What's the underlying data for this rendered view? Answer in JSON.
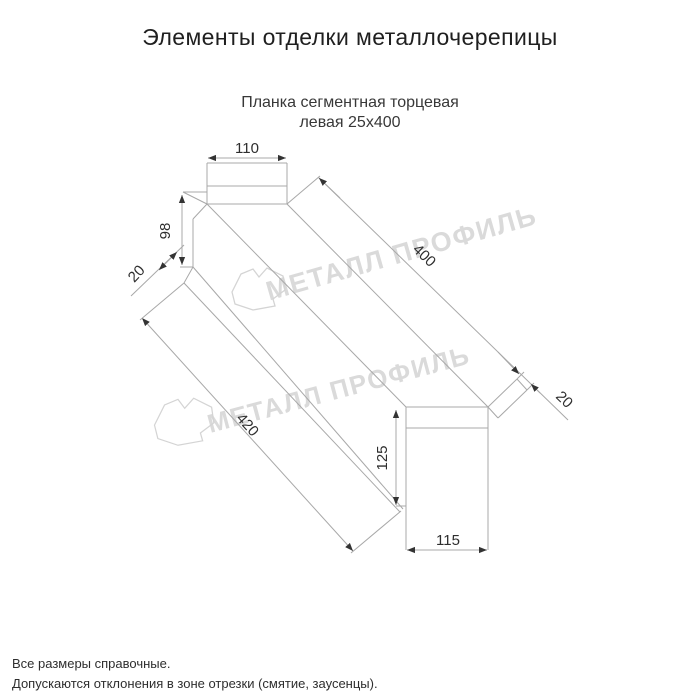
{
  "page": {
    "title": "Элементы отделки металлочерепицы"
  },
  "product": {
    "subtitle_line1": "Планка сегментная торцевая",
    "subtitle_line2": "левая 25х400"
  },
  "drawing": {
    "dims": {
      "top_width": "110",
      "side_height": "98",
      "hem_near": "20",
      "edge_top_length": "400",
      "edge_bottom_length": "420",
      "hem_far": "20",
      "end_height": "125",
      "end_width": "115"
    }
  },
  "watermark": {
    "text": "МЕТАЛЛ ПРОФИЛЬ"
  },
  "footer": {
    "note1": "Все размеры справочные.",
    "note2": "Допускаются отклонения в зоне отрезки (смятие, заусенцы)."
  },
  "colors": {
    "line": "#a8a8a8",
    "dim_text": "#2e2e2e",
    "arrow": "#333333",
    "watermark": "#dadada",
    "background": "#ffffff"
  }
}
